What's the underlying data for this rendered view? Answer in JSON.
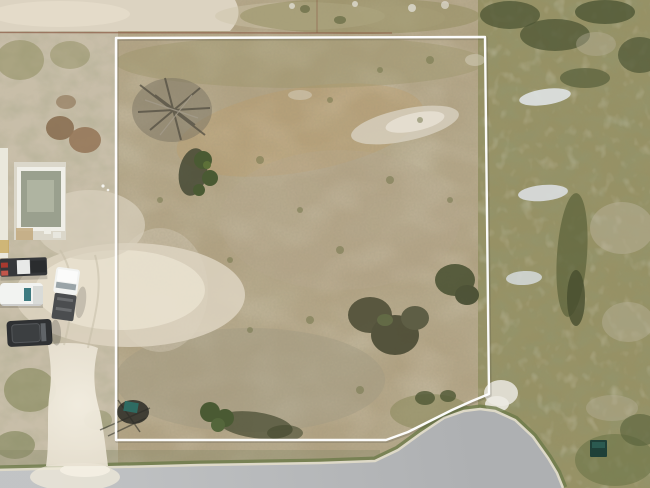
{
  "image": {
    "type": "aerial-drone-photo",
    "subject": "vacant scrub land parcel outlined with a white property boundary, curved paved street at bottom right, parked work trucks and a small foundation structure on the left, bright sand driveway to the road"
  },
  "boundary": {
    "label": "property-boundary",
    "color": "#ffffff",
    "points": "116,38 485,37 489,394 472,401 452,410 430,421 408,432 386,440 116,440"
  },
  "road": {
    "curb_points": "-5,470 80,468 200,465 320,463 375,461 398,450 420,434 444,418 464,411 480,409 495,411 515,420 533,437 548,458 557,473 563,488",
    "surface_points": "-5,470 80,468 200,465 320,463 375,461 398,450 420,434 444,418 464,411 480,409 495,411 515,420 533,437 548,458 557,473 563,488 -5,488"
  },
  "colors": {
    "field_base": "#b1a283",
    "field_gold": "#c09a63",
    "dirt_light": "#cbc2ae",
    "sand_path": "#dcd3c1",
    "sand_bright": "#efe9da",
    "veg_right": "#938f62",
    "veg_dark": "#4d5634",
    "tree_green": "#4a5a33",
    "shadow": "#45492f",
    "rock_white": "#e2e2da",
    "road": "#b3b5b7",
    "curb": "#ded9c8",
    "verge_green": "#6d7a4a",
    "truck_white": "#f2f3f1",
    "truck_dark": "#35373a",
    "suv_dark": "#2f3133",
    "teal_glass": "#3e7a80",
    "dumpster_teal": "#1f4038",
    "dirt_pile": "#8a6f52",
    "building_frame": "#f0efe8",
    "building_inner": "#9aa08e",
    "dirt_line_red": "#8a5a43"
  },
  "objects": [
    {
      "label": "property boundary outline"
    },
    {
      "label": "paved street curve with curb"
    },
    {
      "label": "bright sand driveway"
    },
    {
      "label": "dark flatbed truck"
    },
    {
      "label": "white work van"
    },
    {
      "label": "white pickup truck with dark bed"
    },
    {
      "label": "dark suv"
    },
    {
      "label": "building foundation under construction"
    },
    {
      "label": "brown dirt piles"
    },
    {
      "label": "dead brush pile"
    },
    {
      "label": "green trees with shadows"
    },
    {
      "label": "white rock rubble piles"
    },
    {
      "label": "teal dumpster"
    },
    {
      "label": "sandy track along top edge"
    }
  ]
}
